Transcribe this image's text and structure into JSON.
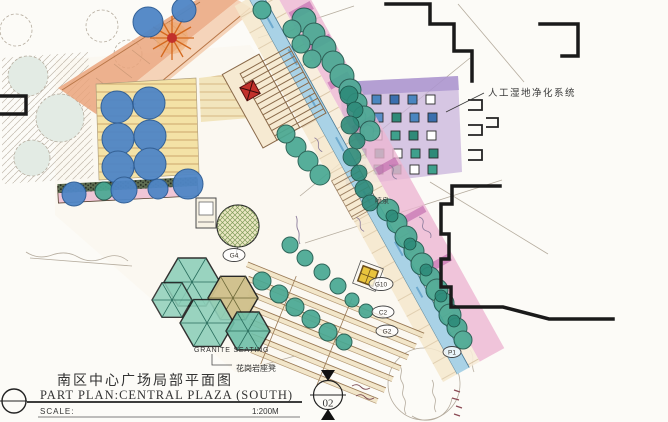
{
  "colors": {
    "paper": "#fcfbf7",
    "ink": "#1a1a1a",
    "pencil": "#b5ac9e",
    "water_blue": "#a9d2e6",
    "tree_teal": "#49a893",
    "tree_teal_dark": "#2e8b7a",
    "tree_blue": "#4f86c6",
    "promenade_pink": "#ecb6d2",
    "accent_magenta": "#b95aa6",
    "paving_yellow": "#f4e2a6",
    "wetland_lavender": "#c9b4dc",
    "accent_red": "#c2312b",
    "step_brown": "#8a6a4a"
  },
  "title_block": {
    "title_cn": "南区中心广场局部平面图",
    "title_en": "PART PLAN:CENTRAL PLAZA (SOUTH)",
    "scale_label": "SCALE:",
    "scale_value": "1:200M"
  },
  "annotations": {
    "wetland_system": "人工湿地净化系统",
    "fountain": "喷泉",
    "granite_seating_en": "GRANITE SEATING",
    "granite_seating_cn": "花岗岩座凳",
    "section_number": "02"
  },
  "plant_markers": [
    {
      "code": "G4"
    },
    {
      "code": "G10"
    },
    {
      "code": "C2"
    },
    {
      "code": "G2"
    },
    {
      "code": "P1"
    }
  ]
}
